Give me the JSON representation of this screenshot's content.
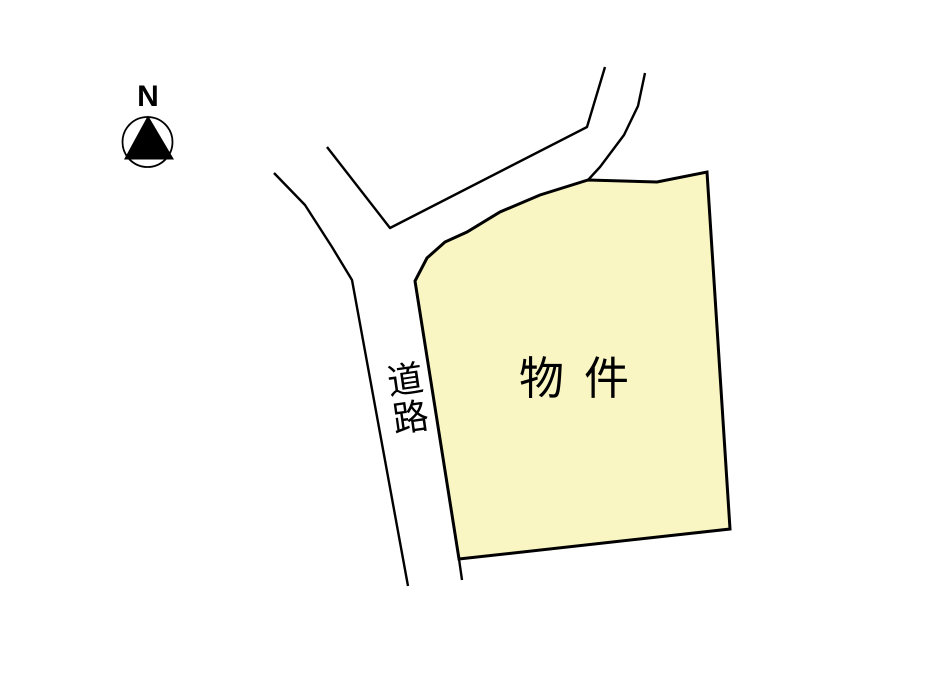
{
  "compass": {
    "label": "N"
  },
  "road": {
    "label": "道路"
  },
  "property": {
    "label": "物件"
  },
  "colors": {
    "background": "#ffffff",
    "line_color": "#000000",
    "text_color": "#000000",
    "property_fill": "#faf6c3"
  }
}
